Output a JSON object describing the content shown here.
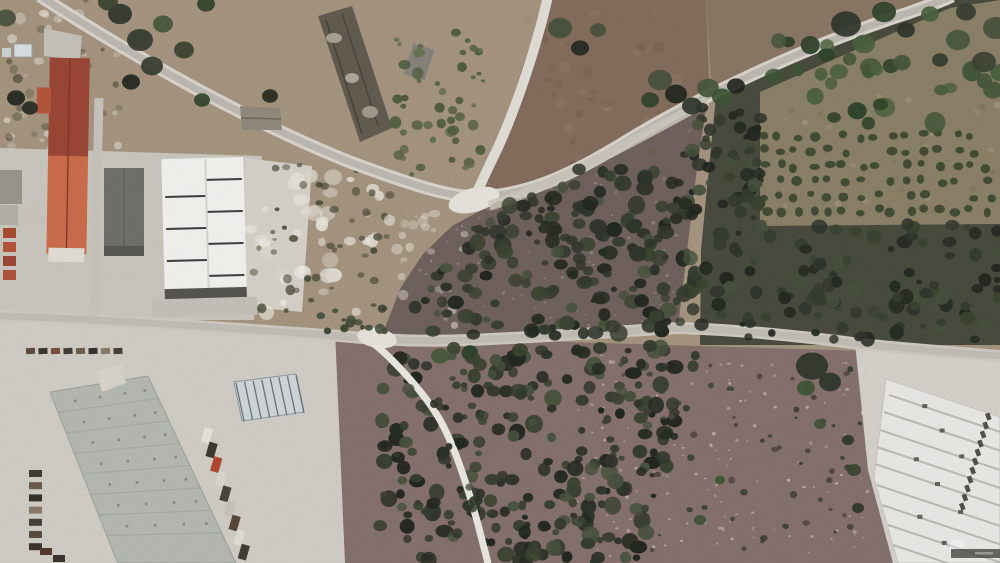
{
  "lot_overlay": {
    "label_line1": "LOTE c/",
    "area_value": "7.055m",
    "area_sup": "2",
    "outline_color": "#c63838",
    "polygon_points": "707,101 675,119 645,136 615,152 585,168 558,181 534,191 511,199 489,206 468,215 452,226 436,240 423,254 411,270 401,287 393,304 387,319 384,330 386,338 393,342 430,342 480,340 530,337 575,334 622,330 662,328 678,327 683,296 688,254 692,218 697,168 702,130 707,101"
  },
  "watermarks": {
    "portal": "imovirtual",
    "agency_letter_x": "X",
    "agency_letter_p": "p",
    "agency_word": "REALTY"
  }
}
